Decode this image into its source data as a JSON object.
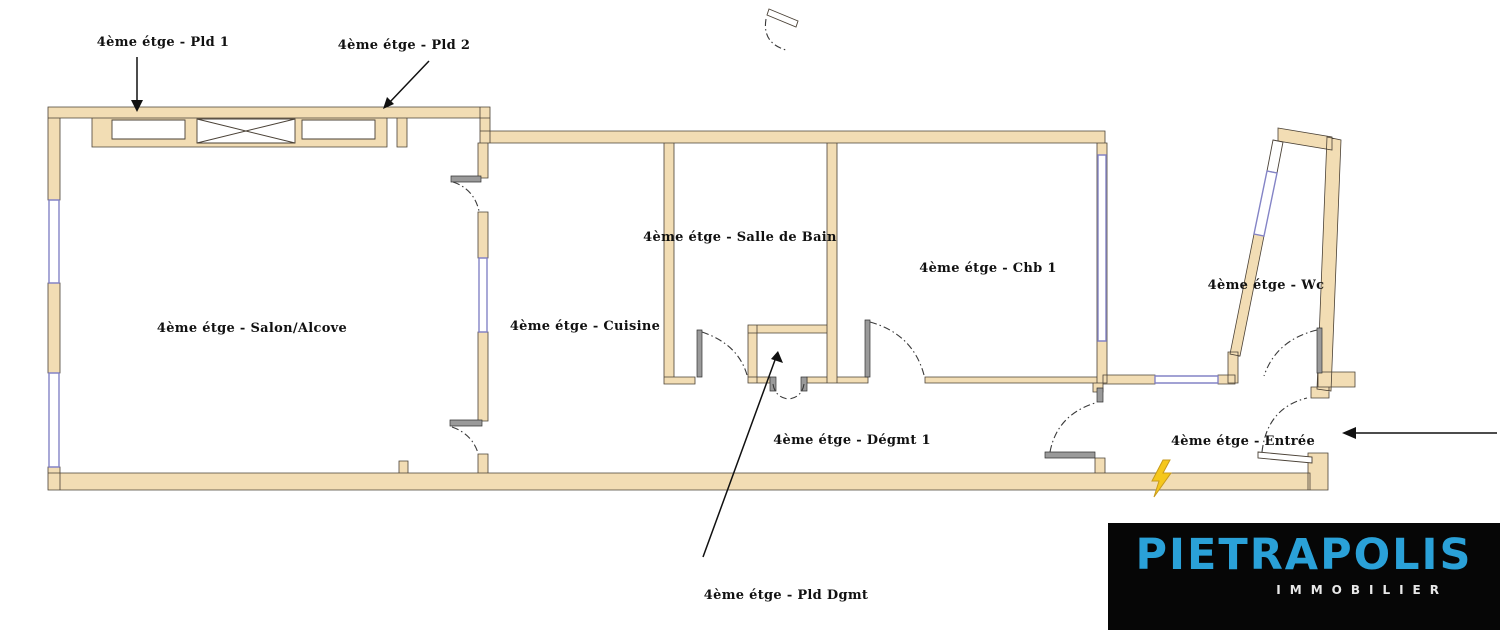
{
  "plan": {
    "labels": {
      "pld1": "4ème étge - Pld 1",
      "pld2": "4ème étge - Pld 2",
      "salon": "4ème étge - Salon/Alcove",
      "cuisine": "4ème étge - Cuisine",
      "salle_de_bain": "4ème étge - Salle de Bain",
      "chb1": "4ème étge - Chb 1",
      "wc": "4ème étge - Wc",
      "degmt1": "4ème étge - Dégmt 1",
      "entree": "4ème étge - Entrée",
      "pld_dgmt": "4ème étge - Pld Dgmt"
    },
    "symbols": [
      "lightning-icon",
      "door-swing-icon",
      "closet-x-icon",
      "window-glazing"
    ],
    "colors": {
      "wall_fill": "#F2DDB4",
      "wall_stroke": "#4A4136",
      "window_stroke": "#8484C6",
      "door_arc": "#3A3A3A",
      "leaf_fill": "#9A9A9A",
      "label_color": "#111111",
      "arrow_color": "#111111",
      "electric_yellow": "#F5C71C",
      "electric_outline": "#C79A1C"
    }
  },
  "logo": {
    "brand": "PIETRAPOLIS",
    "tagline": "IMMOBILIER",
    "brand_color": "#2AA1D8",
    "tagline_color": "#E8E8E8",
    "background": "#060606"
  }
}
